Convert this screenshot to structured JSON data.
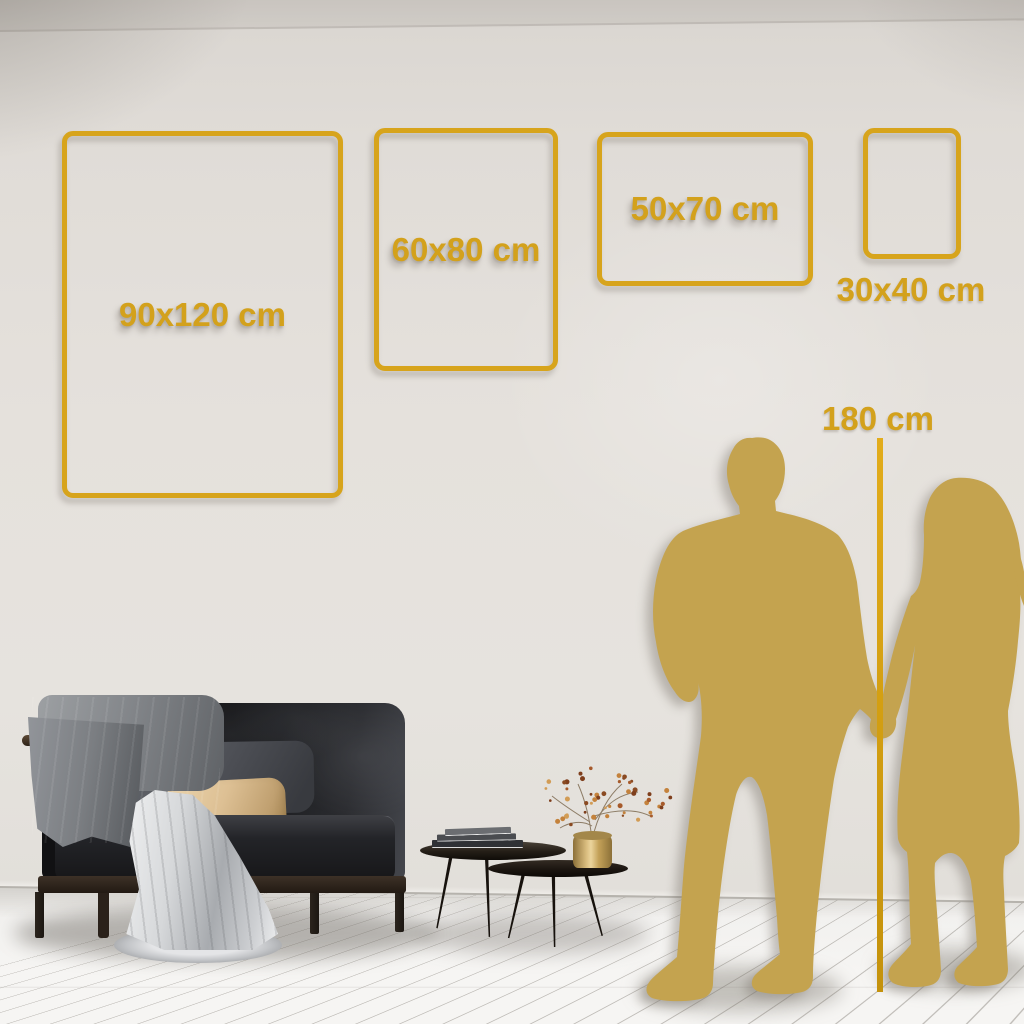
{
  "size_guide": {
    "frames": [
      {
        "label": "90x120 cm"
      },
      {
        "label": "60x80 cm"
      },
      {
        "label": "50x70 cm"
      },
      {
        "label": "30x40 cm"
      }
    ],
    "height_reference": {
      "label": "180 cm"
    }
  },
  "icons": {
    "man": "man-silhouette",
    "woman": "woman-silhouette"
  },
  "colors": {
    "accent_gold": "#D5A31C",
    "line_gold": "#D5A011",
    "silhouette_gold": "#C4A34F",
    "wall": "#E4E0DB",
    "floor": "#F4F3F1"
  }
}
